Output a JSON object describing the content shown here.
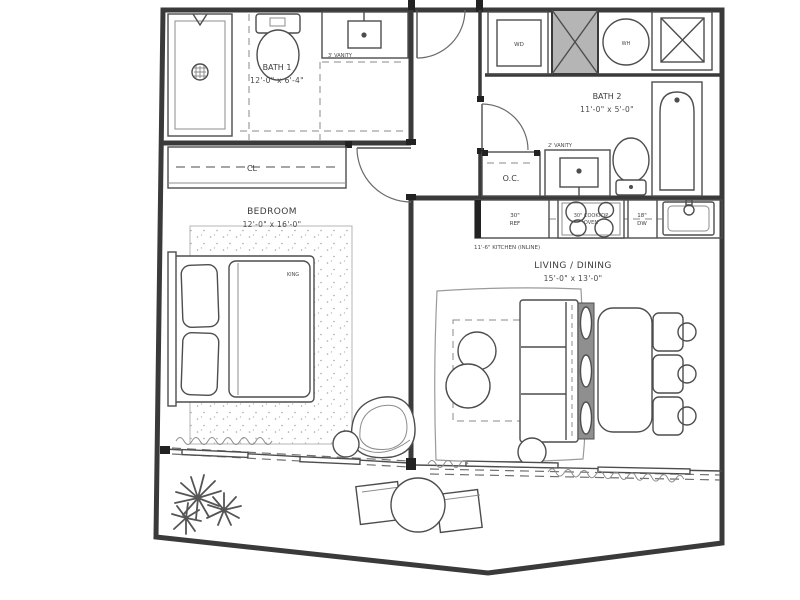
{
  "plan": {
    "rooms": {
      "bath1": {
        "name": "BATH 1",
        "dims": "12'-0\" x 6'-4\""
      },
      "bath2": {
        "name": "BATH 2",
        "dims": "11'-0\" x 5'-0\""
      },
      "bedroom": {
        "name": "BEDROOM",
        "dims": "12'-0\" x 16'-0\""
      },
      "living": {
        "name": "LIVING / DINING",
        "dims": "15'-0\" x 13'-0\""
      }
    },
    "fixtures": {
      "closet": "CL",
      "bed": "KING",
      "washer_dryer": "WD",
      "water_heater": "WH",
      "owners_closet": "O.C.",
      "vanity1": "3' VANITY",
      "vanity2": "2' VANITY"
    },
    "kitchen": {
      "fridge_size": "30\"",
      "fridge": "REF",
      "cooktop_line1": "30\" COOKTOP",
      "cooktop_line2": "OVEN",
      "dishwasher_size": "18\"",
      "dishwasher": "DW",
      "note": "11'-6\" KITCHEN (INLINE)"
    },
    "colors": {
      "wall": "#3a3a3a",
      "shaft_fill": "#b5b5b5",
      "text": "#3c3c3c",
      "background": "#ffffff"
    }
  }
}
